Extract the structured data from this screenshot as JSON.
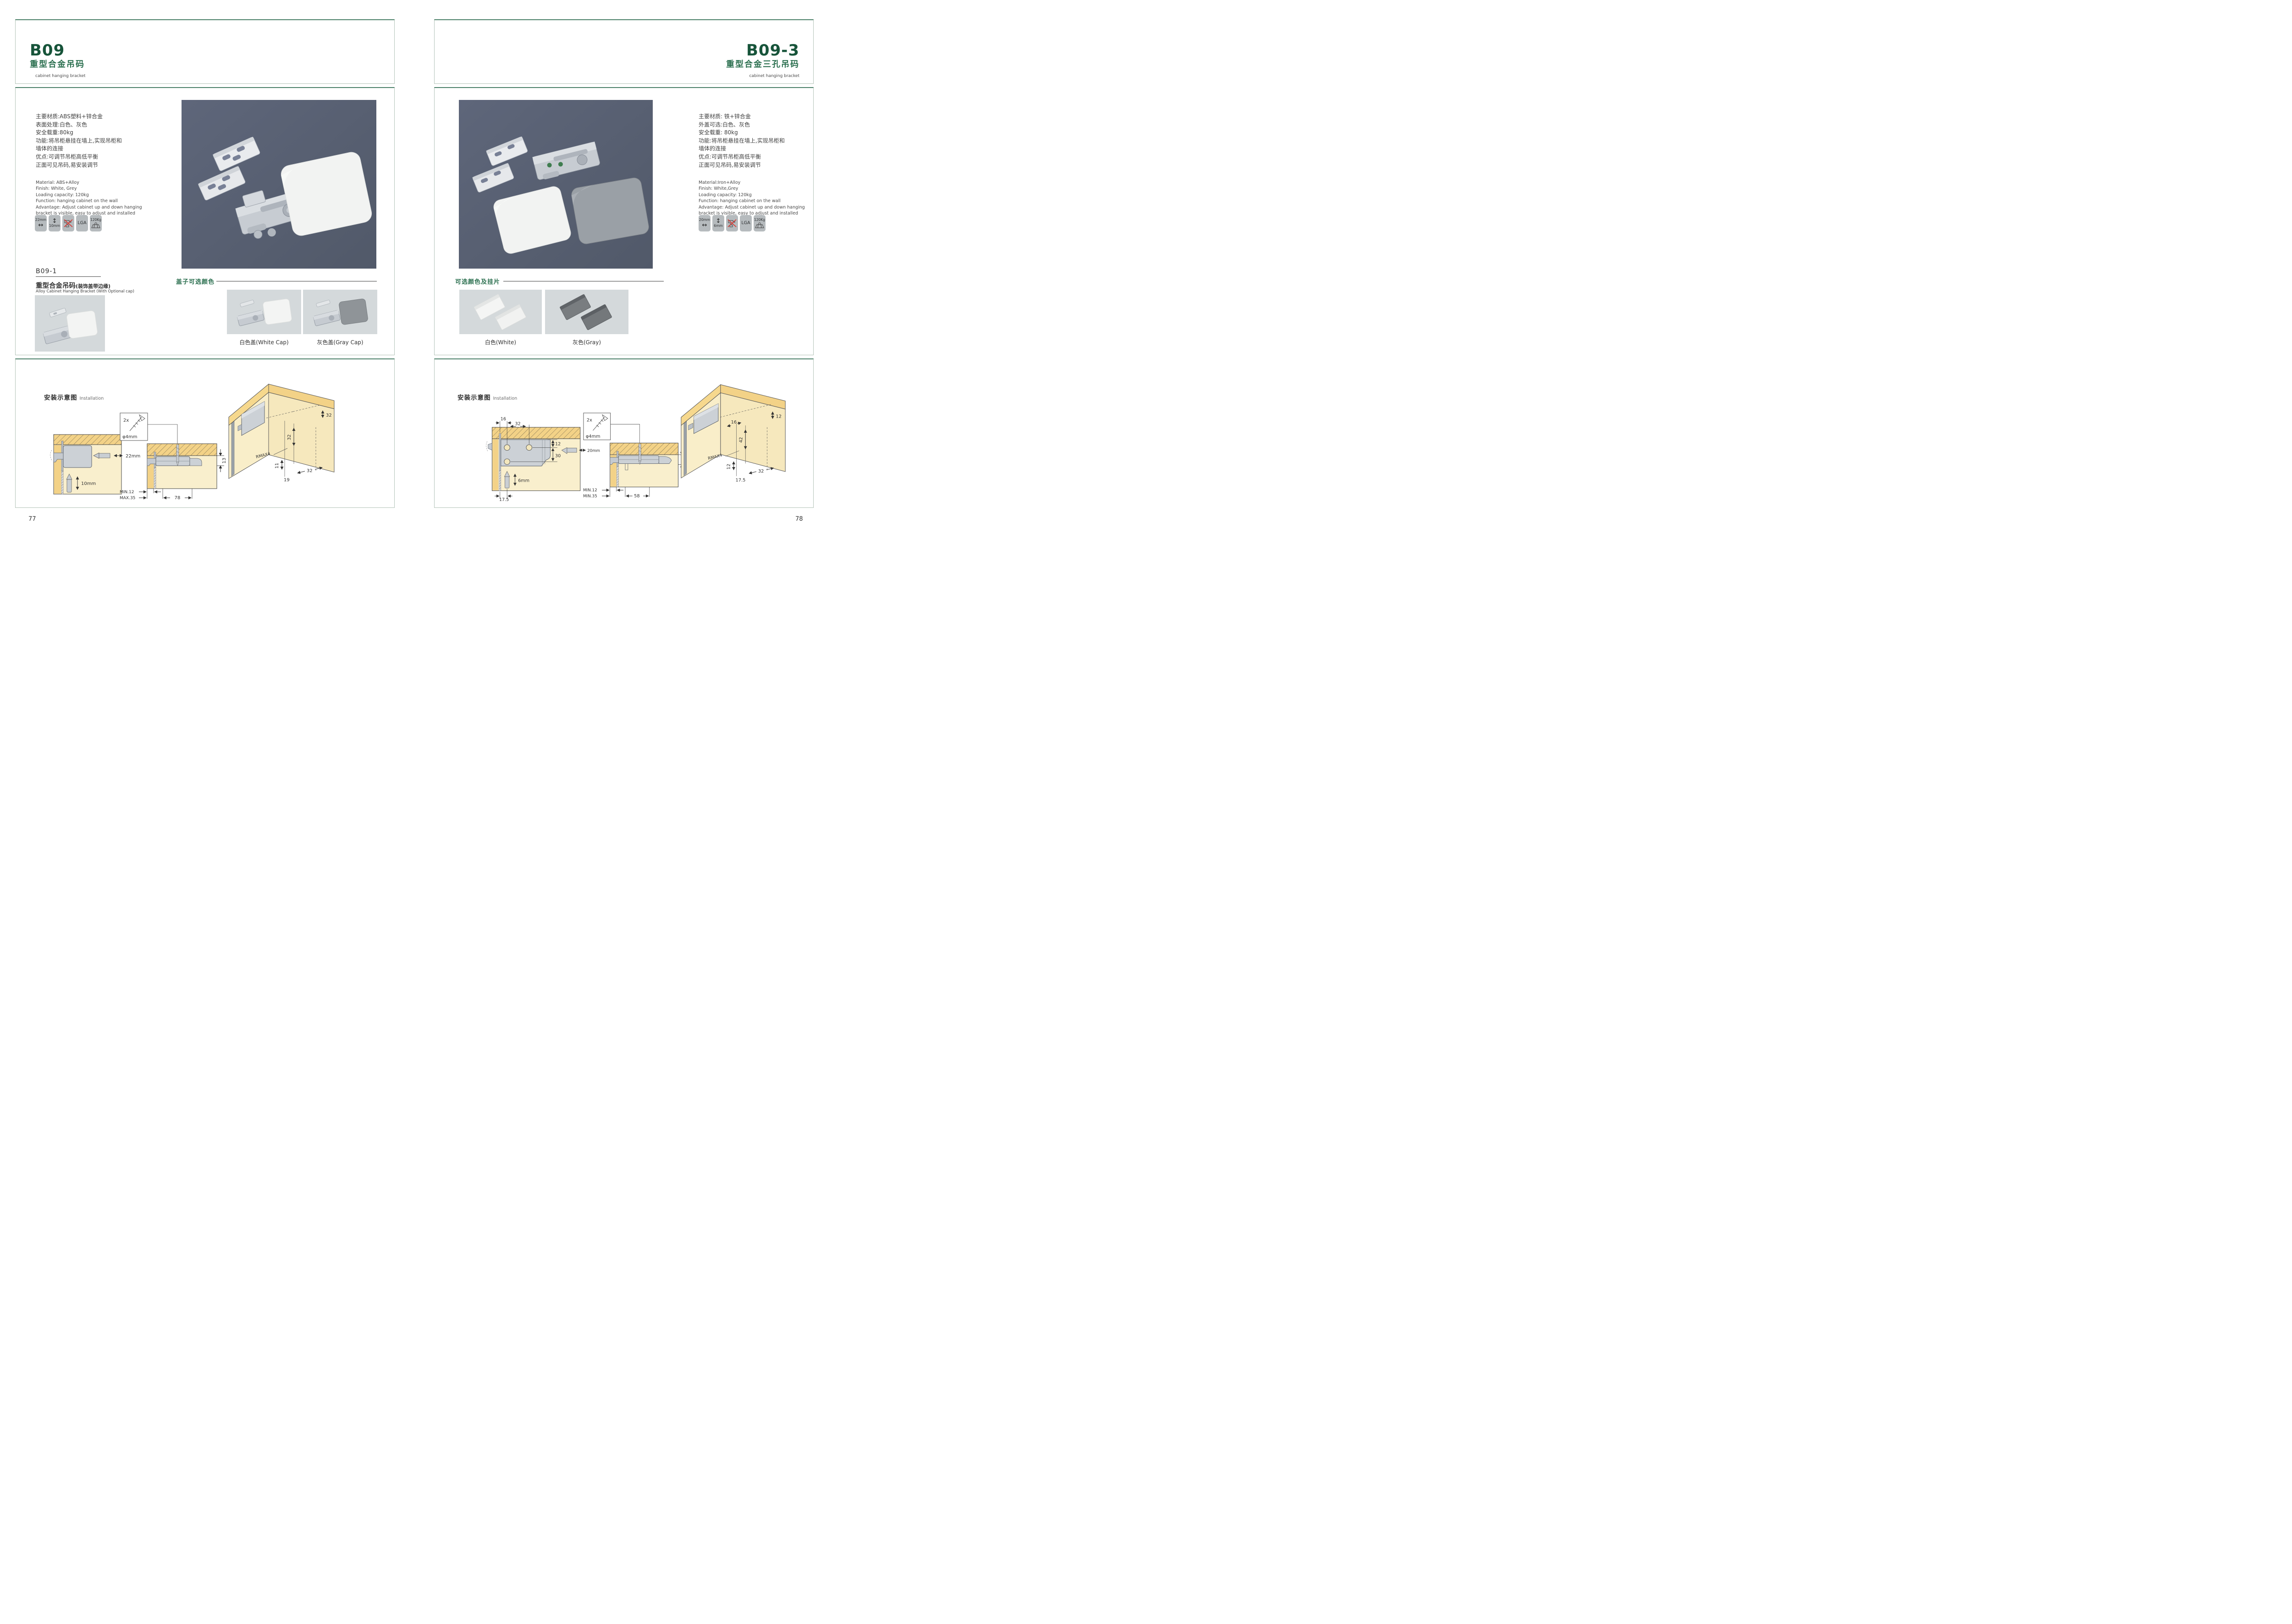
{
  "colors": {
    "accent_green": "#17543a",
    "heading_green": "#2c7050",
    "box_border_green": "#4c8169",
    "box_border_light": "#b3c3b8",
    "photo_background": "#59617a",
    "swatch_background": "#d4d9db",
    "icon_background": "#b6bbbe",
    "wood_yellow": "#f3d287",
    "panel_cream": "#f9efcd",
    "no_drill_red": "#d83a34"
  },
  "left_page": {
    "page_number": "77",
    "header": {
      "code": "B09",
      "title_cn": "重型合金吊码",
      "subtitle_en": "cabinet hanging bracket"
    },
    "specs_cn": [
      "主要材质:ABS塑料+锌合金",
      "表面处理:白色、灰色",
      "安全载重:80kg",
      "功能:将吊柜悬挂在墙上,实现吊柜和",
      "墙体的连接",
      "优点:可调节吊柜高低平衡",
      "正面可见吊码,易安装调节"
    ],
    "specs_en": [
      "Material: ABS+Alloy",
      "Finish: White, Grey",
      "Loading capacity: 120kg",
      "Function: hanging cabinet on the wall",
      "Advantage: Adjust cabinet up and down hanging",
      "bracket is visible, easy to adjust and installed"
    ],
    "icons": {
      "width": "22mm",
      "height": "10mm",
      "lga": "LGA",
      "load": "120Kg"
    },
    "sub_product": {
      "code": "B09-1",
      "title_cn": "重型合金吊码",
      "title_cn_paren": "(装饰盖带边缘)",
      "title_en": "Alloy Cabinet Hanging Bracket (With Optional cap)"
    },
    "cap_section": {
      "heading": "盖子可选颜色",
      "options": [
        "白色盖(White Cap)",
        "灰色盖(Gray Cap)"
      ]
    },
    "installation": {
      "heading_cn": "安装示意图",
      "heading_en": "Installation",
      "diagram1": {
        "width_label": "22mm",
        "height_label": "10mm"
      },
      "diagram2": {
        "qty": "2x",
        "screw": "φ4mm",
        "side": "13",
        "row1": "MIN.12",
        "row2": "MAX.35",
        "span": "78"
      },
      "diagram3": {
        "top": "32",
        "mid": "32",
        "radius": "RMAX4",
        "a": "11",
        "b": "19",
        "c": "32"
      }
    }
  },
  "right_page": {
    "page_number": "78",
    "header": {
      "code": "B09-3",
      "title_cn": "重型合金三孔吊码",
      "subtitle_en": "cabinet hanging bracket"
    },
    "specs_cn": [
      "主要材质: 铁+锌合金",
      "外盖可选:白色、灰色",
      "安全载重: 80kg",
      "功能:将吊柜悬挂在墙上,实现吊柜和",
      "墙体的连接",
      "优点:可调节吊柜高低平衡",
      "正面可见吊码,易安装调节"
    ],
    "specs_en": [
      "Material:Iron+Alloy",
      "Finish: White,Grey",
      "Loading capacity: 120kg",
      "Function: hanging cabinet on the wall",
      "Advantage: Adjust cabinet up and down hanging",
      "bracket is visible, easy to adjust and installed"
    ],
    "icons": {
      "width": "20mm",
      "height": "6mm",
      "lga": "LGA",
      "load": "120Kg"
    },
    "cap_section": {
      "heading": "可选颜色及挂片",
      "options": [
        "白色(White)",
        "灰色(Gray)"
      ]
    },
    "installation": {
      "heading_cn": "安装示意图",
      "heading_en": "Installation",
      "diagram1": {
        "a": "16",
        "b": "32",
        "c": "12",
        "d": "30",
        "width_label": "20mm",
        "height_label": "6mm",
        "e": "17.5"
      },
      "diagram2": {
        "qty": "2x",
        "screw": "φ4mm",
        "side": "12",
        "row1": "MIN.12",
        "row2": "MIN.35",
        "span": "58"
      },
      "diagram3": {
        "a": "16",
        "b": "12",
        "c": "42",
        "radius": "RMAX4",
        "d": "12",
        "e": "17.5",
        "f": "32"
      }
    }
  }
}
